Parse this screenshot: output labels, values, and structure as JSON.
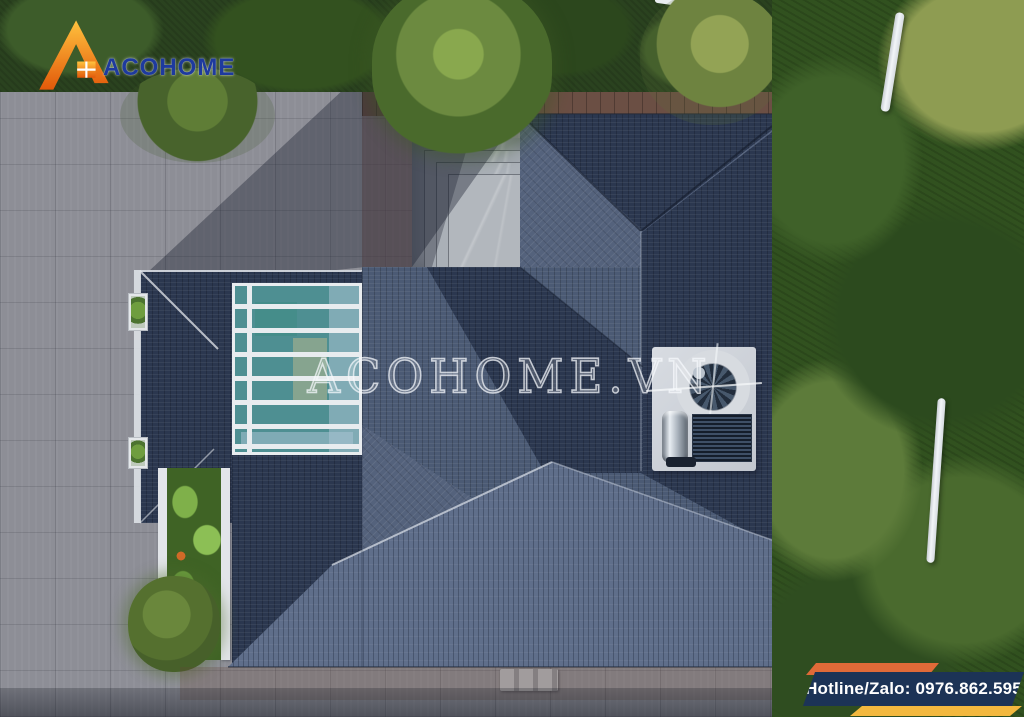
{
  "brand": {
    "name": "ACOHOME",
    "logo_icon": "house-logo-icon"
  },
  "watermark": {
    "text": "ACOHOME.VN"
  },
  "contact": {
    "hotline_label": "Hotline/Zalo: 0976.862.595"
  },
  "colors": {
    "roof_dark": "#2b374f",
    "roof_mid": "#4b5a74",
    "roof_light": "#5f6e8a",
    "roof_gray": "#54627c",
    "skylight_teal": "#4e8f92",
    "pavement": "#8d8e96",
    "trees_dark": "#2a421f",
    "trees_light": "#8e9c52",
    "logo_blue": "#1e3a9e",
    "logo_orange": "#f08c1e",
    "banner_navy": "#1c3356",
    "banner_orange": "#e06a38",
    "banner_yellow": "#f3b83e"
  }
}
